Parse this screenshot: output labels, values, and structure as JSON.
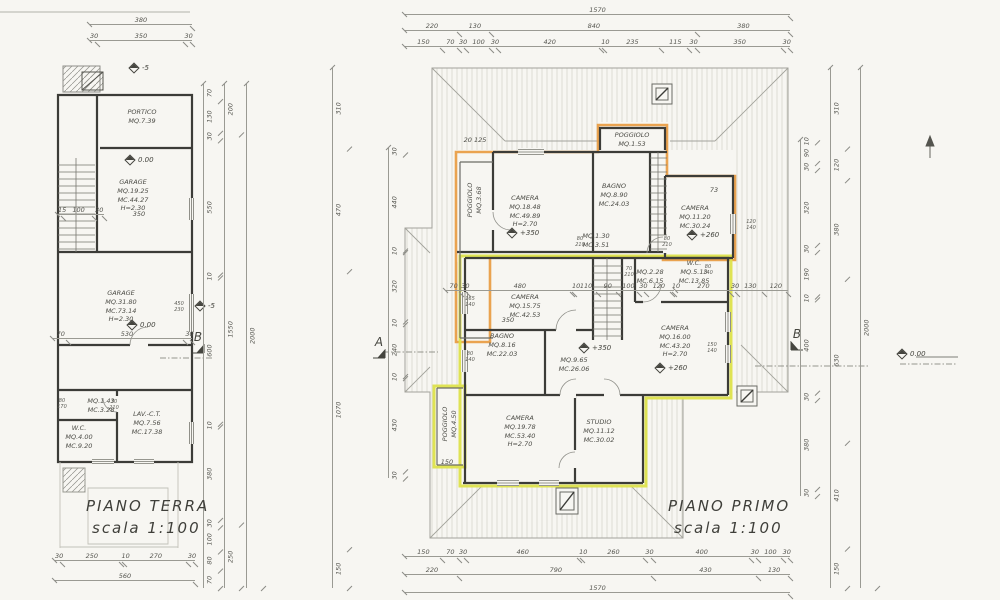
{
  "colors": {
    "paper": "#f7f6f2",
    "wall": "#3c3c38",
    "accent_orange": "#e89a3e",
    "accent_yellow": "#dde24b"
  },
  "piano_terra": {
    "title": "PIANO TERRA",
    "scale_label": "scala 1:100",
    "rooms": {
      "portico": "PORTICO\nMQ.7.39",
      "garage1": "GARAGE\nMQ.19.25\nMC.44.27\nH=2.30",
      "garage2": "GARAGE\nMQ.31.80\nMC.73.14\nH=2.30",
      "disimpegno": "MQ.1.43\nMC.3.28",
      "lav_ct": "LAV.-C.T.\nMQ.7.56\nMC.17.38",
      "wc": "W.C.\nMQ.4.00\nMC.9.20"
    },
    "levels": {
      "zero_a": "0.00",
      "zero_b": "0.00",
      "minus5_a": "-5",
      "minus5_b": "-5"
    },
    "sections": {
      "b": "B"
    },
    "dims": {
      "top_total": [
        "380"
      ],
      "top_detail": [
        "30",
        "350",
        "30"
      ],
      "bottom_detail": [
        "30",
        "250",
        "10",
        "270",
        "30"
      ],
      "bottom_total": [
        "560"
      ],
      "right_inner": [
        "70",
        "130",
        "30",
        "550",
        "10",
        "600",
        "10",
        "380",
        "30",
        "100",
        "80",
        "70"
      ],
      "right_mid": [
        "200",
        "1550",
        "250"
      ],
      "right_outer": [
        "2000"
      ],
      "in_350": "350",
      "in_left": [
        "15",
        "100",
        "30"
      ],
      "in_garage": [
        "70",
        "530",
        "30"
      ],
      "fr_80_170": "80\n170",
      "fr_450_230": "450\n230",
      "fr_70_210": "70\n210"
    }
  },
  "piano_primo": {
    "title": "PIANO PRIMO",
    "scale_label": "scala 1:100",
    "rooms": {
      "poggiolo_top": "POGGIOLO\nMQ.1.53",
      "poggiolo_left": "POGGIOLO\nMQ.3.68",
      "camera1": "CAMERA\nMQ.18.48\nMC.49.89\nH=2.70",
      "bagno1": "BAGNO\nMQ.8.90\nMC.24.03",
      "camera2": "CAMERA\nMQ.11.20\nMC.30.24",
      "disimpegno1": "MQ.1.30\nMC.3.51",
      "wc": "W.C.\nMQ.5.13\nMC.13.85",
      "ripostiglio": "MQ.2.28\nMC.6.15",
      "camera3": "CAMERA\nMQ.15.75\nMC.42.53",
      "bagno2": "BAGNO\nMQ.8.16\nMC.22.03",
      "disimpegno2": "MQ.9.65\nMC.26.06",
      "camera4": "CAMERA\nMQ.16.00\nMC.43.20\nH=2.70",
      "poggiolo_bottom": "POGGIOLO\nMQ.4.50",
      "camera5": "CAMERA\nMQ.19.78\nMC.53.40\nH=2.70",
      "studio": "STUDIO\nMQ.11.12\nMC.30.02"
    },
    "levels": {
      "p350_a": "+350",
      "p350_b": "+350",
      "p260_a": "+260",
      "p260_b": "+260"
    },
    "sections": {
      "a": "A",
      "b": "B"
    },
    "dims": {
      "top_total": [
        "1570"
      ],
      "top_mid": [
        "220",
        "130",
        "840",
        "380"
      ],
      "top_detail": [
        "150",
        "70",
        "30",
        "100",
        "30",
        "420",
        "10",
        "235",
        "115",
        "30",
        "350",
        "30"
      ],
      "bottom_detail": [
        "150",
        "70",
        "30",
        "460",
        "10",
        "260",
        "30",
        "400",
        "30",
        "100",
        "30"
      ],
      "bottom_mid": [
        "220",
        "790",
        "430",
        "130"
      ],
      "bottom_total": [
        "1570"
      ],
      "left_outer": [
        "310",
        "470",
        "1070",
        "150"
      ],
      "left_inner": [
        "30",
        "440",
        "10",
        "320",
        "10",
        "240",
        "10",
        "430",
        "30"
      ],
      "right_inner": [
        "10",
        "90",
        "30",
        "320",
        "30",
        "190",
        "10",
        "400",
        "30",
        "380",
        "30"
      ],
      "right_mid": [
        "310",
        "120",
        "380",
        "630",
        "410",
        "150"
      ],
      "right_outer": [
        "2000"
      ],
      "mid_detail": [
        "70",
        "30",
        "480",
        "10",
        "110",
        "90",
        "100",
        "30",
        "120",
        "10"
      ],
      "mid_right": [
        "270",
        "30",
        "130",
        "120"
      ],
      "in_350": "350",
      "in_150": "150",
      "in_73": "73",
      "in_20_125": "20   125",
      "fr_a": "80\n210",
      "fr_b": "80\n210",
      "fr_c": "80\n140",
      "fr_d": "120\n140",
      "fr_e": "150\n140",
      "fr_f": "165\n140",
      "fr_g": "80\n140",
      "fr_h": "70\n210"
    }
  },
  "annotations": {
    "level_zero_right": "0.00"
  }
}
